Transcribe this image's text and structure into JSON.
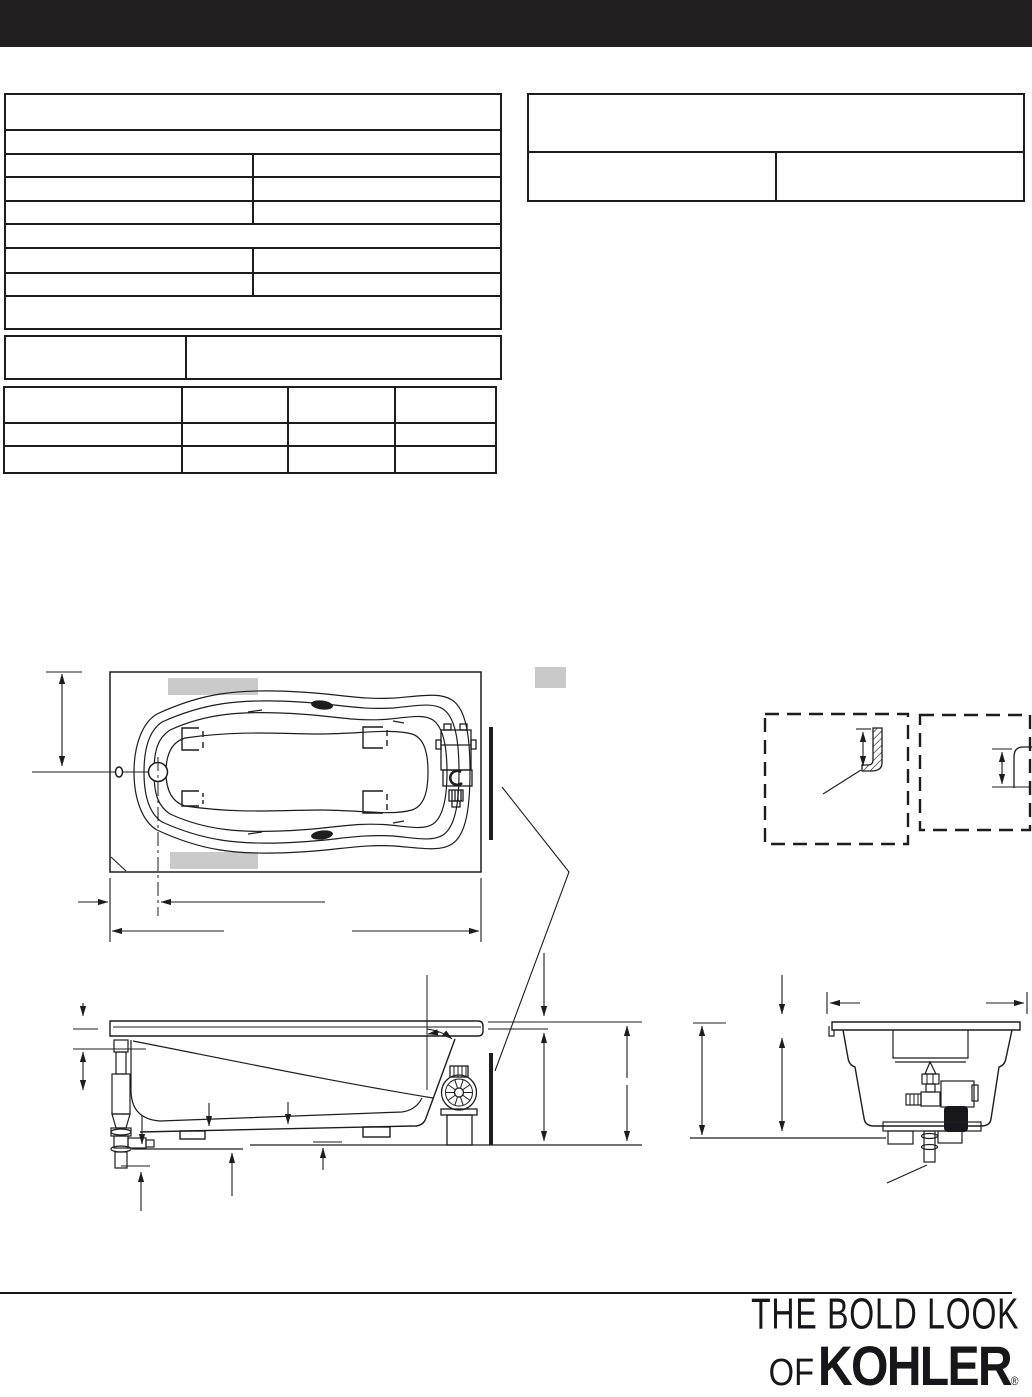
{
  "header": {
    "bar_color": "#221e1f"
  },
  "logo": {
    "tagline_line1": "THE BOLD LOOK",
    "tagline_line2_prefix": "OF",
    "brand": "KOHLER",
    "registered_mark": "®"
  },
  "drawing": {
    "ink_color": "#1d1d1f",
    "pad_color": "#cacaca",
    "note_marker_color": "#c9c9c9",
    "views": [
      "bath-plan-view",
      "bath-side-elevation",
      "bath-end-section",
      "rim-flange-detail",
      "rim-profile-detail"
    ]
  }
}
